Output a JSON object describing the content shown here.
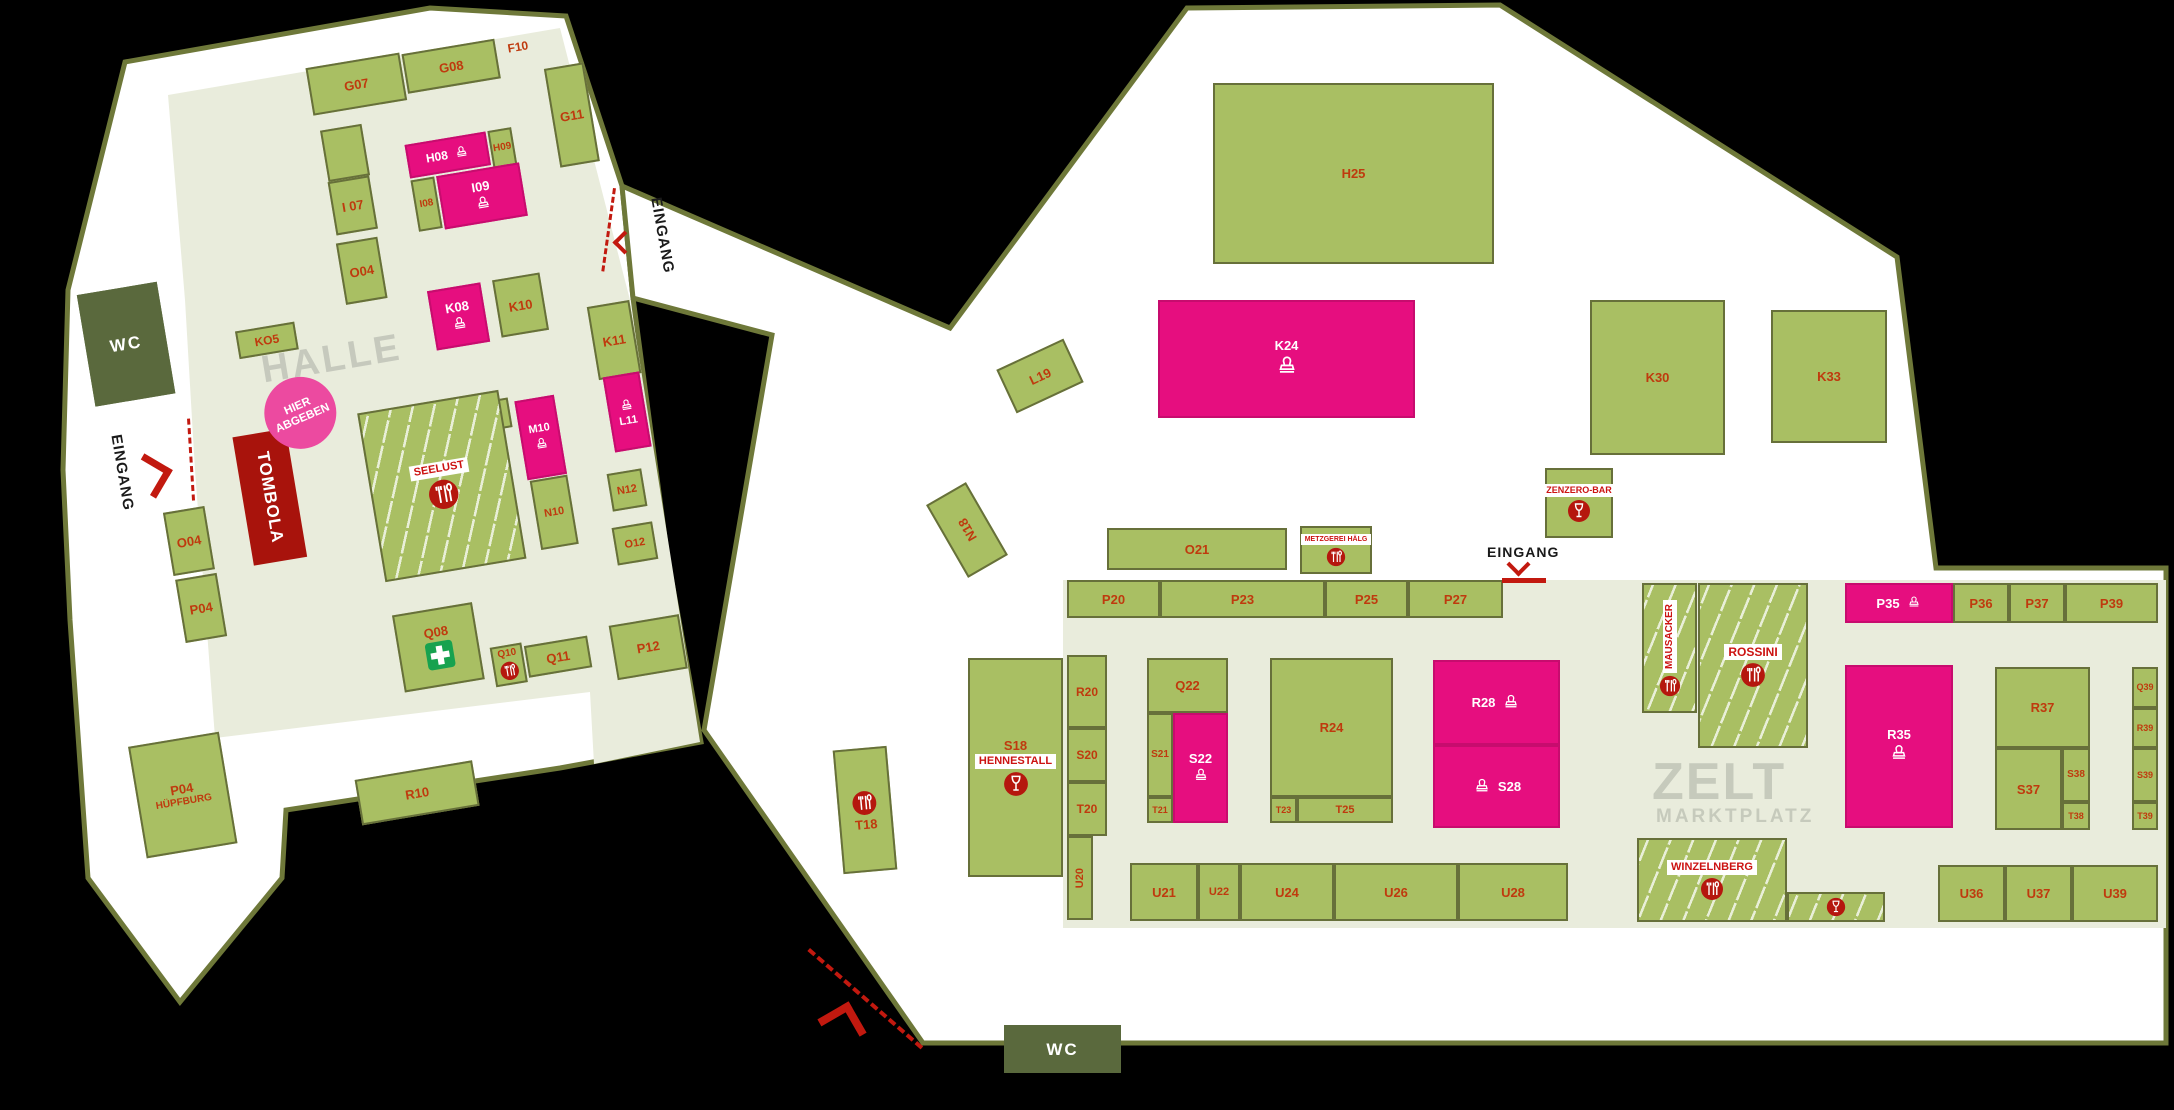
{
  "colors": {
    "green": "#a9bf63",
    "pink": "#e60e7f",
    "label_red": "#bf3a0e",
    "badge_red": "#cc1312",
    "dark_green": "#5a693d",
    "dark_red_tombola": "#a8130c",
    "accent_red": "#c2190f",
    "olive_border": "#6e7839",
    "map_light": "#e9ecdc",
    "title_gray": "#c6c9bd",
    "white": "#ffffff"
  },
  "halle": {
    "labels": {
      "title": "HALLE",
      "tombola": "TOMBOLA",
      "dropoff": "HIER ABGEBEN",
      "entrance_west": "EINGANG",
      "entrance_east": "EINGANG"
    },
    "stalls": [
      {
        "l": "G07",
        "x": 177,
        "y": 36,
        "w": 95,
        "h": 48
      },
      {
        "l": "G08",
        "x": 274,
        "y": 38,
        "w": 94,
        "h": 40
      },
      {
        "l": "F10",
        "x": 364,
        "y": 42,
        "w": 52,
        "h": 16,
        "k": "lbl"
      },
      {
        "l": "G11",
        "x": 412,
        "y": 76,
        "w": 40,
        "h": 100
      },
      {
        "l": "",
        "x": 181,
        "y": 100,
        "w": 42,
        "h": 52
      },
      {
        "l": "I 07",
        "x": 180,
        "y": 152,
        "w": 42,
        "h": 54
      },
      {
        "l": "O04",
        "x": 178,
        "y": 214,
        "w": 42,
        "h": 62
      },
      {
        "l": "H08",
        "x": 262,
        "y": 128,
        "w": 82,
        "h": 34,
        "k": "p",
        "i": "stamp-icon",
        "lay": "row",
        "is": 16,
        "fs": 12
      },
      {
        "l": "H09",
        "x": 346,
        "y": 128,
        "w": 24,
        "h": 38,
        "fs": 10
      },
      {
        "l": "I08",
        "x": 262,
        "y": 164,
        "w": 24,
        "h": 52,
        "fs": 10
      },
      {
        "l": "I09",
        "x": 288,
        "y": 164,
        "w": 84,
        "h": 54,
        "k": "p",
        "i": "stamp-icon",
        "is": 18
      },
      {
        "l": "K08",
        "x": 260,
        "y": 276,
        "w": 54,
        "h": 60,
        "k": "p",
        "i": "stamp-icon",
        "is": 18
      },
      {
        "l": "K10",
        "x": 326,
        "y": 276,
        "w": 48,
        "h": 58
      },
      {
        "l": "K11",
        "x": 415,
        "y": 318,
        "w": 43,
        "h": 74
      },
      {
        "l": "L11",
        "x": 419,
        "y": 390,
        "w": 37,
        "h": 76,
        "k": "p",
        "i": "stamp-icon",
        "lay": "stackrev",
        "is": 16,
        "fs": 11
      },
      {
        "l": "N12",
        "x": 407,
        "y": 486,
        "w": 35,
        "h": 38,
        "fs": 11
      },
      {
        "l": "O12",
        "x": 403,
        "y": 540,
        "w": 41,
        "h": 38,
        "fs": 11
      },
      {
        "l": "P12",
        "x": 384,
        "y": 636,
        "w": 71,
        "h": 55
      },
      {
        "l": "M09",
        "x": 218,
        "y": 394,
        "w": 104,
        "h": 30
      },
      {
        "l": "M10",
        "x": 328,
        "y": 399,
        "w": 40,
        "h": 80,
        "k": "p",
        "i": "stamp-icon",
        "is": 16,
        "fs": 11
      },
      {
        "l": "N10",
        "x": 330,
        "y": 480,
        "w": 38,
        "h": 70,
        "fs": 11
      },
      {
        "l": "",
        "badge": "SEELUST",
        "x": 171,
        "y": 385,
        "w": 143,
        "h": 171,
        "k": "pat",
        "i": "restaurant-icon",
        "is": 32
      },
      {
        "l": "Q08",
        "x": 172,
        "y": 590,
        "w": 81,
        "h": 78,
        "i": "firstaid-icon",
        "is": 30
      },
      {
        "l": "Q10",
        "x": 263,
        "y": 638,
        "w": 32,
        "h": 40,
        "i": "restaurant-icon",
        "is": 20,
        "fs": 10
      },
      {
        "l": "Q11",
        "x": 297,
        "y": 642,
        "w": 64,
        "h": 32
      },
      {
        "l": "KO5",
        "x": 64,
        "y": 284,
        "w": 60,
        "h": 28,
        "fs": 12
      },
      {
        "l": "O04",
        "x": -37,
        "y": 451,
        "w": 42,
        "h": 64
      },
      {
        "l": "P04",
        "x": -36,
        "y": 519,
        "w": 42,
        "h": 64
      },
      {
        "l": "R10",
        "x": 108,
        "y": 746,
        "w": 119,
        "h": 46
      },
      {
        "l": "P04",
        "sub": "HÜPFBURG",
        "x": -110,
        "y": 676,
        "w": 92,
        "h": 113
      },
      {
        "l": "WC",
        "x": -86,
        "y": 222,
        "w": 81,
        "h": 113,
        "k": "d"
      }
    ]
  },
  "zelt": {
    "labels": {
      "title": "ZELT",
      "subtitle": "MARKTPLATZ",
      "entrance": "EINGANG",
      "wc": "WC"
    },
    "stalls": [
      {
        "l": "H25",
        "x": 1213,
        "y": 83,
        "w": 281,
        "h": 181
      },
      {
        "l": "K24",
        "x": 1158,
        "y": 300,
        "w": 257,
        "h": 118,
        "k": "p",
        "i": "stamp-icon",
        "is": 26
      },
      {
        "l": "K30",
        "x": 1590,
        "y": 300,
        "w": 135,
        "h": 155
      },
      {
        "l": "K33",
        "x": 1771,
        "y": 310,
        "w": 116,
        "h": 133
      },
      {
        "l": "L19",
        "x": 1003,
        "y": 352,
        "w": 74,
        "h": 48,
        "rot": -25
      },
      {
        "l": "N18",
        "x": 944,
        "y": 488,
        "w": 46,
        "h": 84,
        "rot": -30,
        "vert": 1
      },
      {
        "l": "O21",
        "x": 1107,
        "y": 528,
        "w": 180,
        "h": 42
      },
      {
        "l": "",
        "badge": "METZGEREI HÄLG",
        "x": 1300,
        "y": 526,
        "w": 72,
        "h": 48,
        "i": "restaurant-icon",
        "is": 20,
        "bfs": 7
      },
      {
        "l": "",
        "badge": "ZENZERO-BAR",
        "x": 1545,
        "y": 468,
        "w": 68,
        "h": 70,
        "i": "wine-icon",
        "is": 24,
        "bfs": 9
      },
      {
        "l": "P20",
        "x": 1067,
        "y": 580,
        "w": 93,
        "h": 38
      },
      {
        "l": "P23",
        "x": 1160,
        "y": 580,
        "w": 165,
        "h": 38
      },
      {
        "l": "P25",
        "x": 1325,
        "y": 580,
        "w": 83,
        "h": 38
      },
      {
        "l": "P27",
        "x": 1408,
        "y": 580,
        "w": 95,
        "h": 38
      },
      {
        "l": "R20",
        "x": 1067,
        "y": 655,
        "w": 40,
        "h": 73,
        "fs": 12
      },
      {
        "l": "S20",
        "x": 1067,
        "y": 728,
        "w": 40,
        "h": 54,
        "fs": 12
      },
      {
        "l": "T20",
        "x": 1067,
        "y": 782,
        "w": 40,
        "h": 54,
        "fs": 12
      },
      {
        "l": "U20",
        "x": 1067,
        "y": 836,
        "w": 26,
        "h": 84,
        "vert": 1,
        "fs": 11
      },
      {
        "l": "Q22",
        "x": 1147,
        "y": 658,
        "w": 81,
        "h": 55
      },
      {
        "l": "S21",
        "x": 1147,
        "y": 713,
        "w": 26,
        "h": 84,
        "fs": 10
      },
      {
        "l": "S22",
        "x": 1173,
        "y": 713,
        "w": 55,
        "h": 110,
        "k": "p",
        "i": "stamp-icon",
        "is": 18
      },
      {
        "l": "T21",
        "x": 1147,
        "y": 797,
        "w": 26,
        "h": 26,
        "fs": 9
      },
      {
        "l": "R24",
        "x": 1270,
        "y": 658,
        "w": 123,
        "h": 139
      },
      {
        "l": "T23",
        "x": 1270,
        "y": 797,
        "w": 27,
        "h": 26,
        "fs": 9
      },
      {
        "l": "T25",
        "x": 1297,
        "y": 797,
        "w": 96,
        "h": 26,
        "fs": 11
      },
      {
        "l": "R28",
        "x": 1433,
        "y": 660,
        "w": 127,
        "h": 85,
        "k": "p",
        "i": "stamp-icon",
        "lay": "row",
        "is": 20
      },
      {
        "l": "S28",
        "x": 1433,
        "y": 745,
        "w": 127,
        "h": 83,
        "k": "p",
        "i": "stamp-icon",
        "lay": "rowrev",
        "is": 20
      },
      {
        "l": "",
        "badge": "MAUSACKER",
        "x": 1642,
        "y": 583,
        "w": 55,
        "h": 130,
        "k": "pat",
        "i": "restaurant-icon",
        "is": 22,
        "vbadge": 1,
        "bfs": 10
      },
      {
        "l": "",
        "badge": "ROSSINI",
        "x": 1698,
        "y": 583,
        "w": 110,
        "h": 165,
        "k": "pat",
        "i": "restaurant-icon",
        "is": 26,
        "bfs": 12
      },
      {
        "l": "P35",
        "x": 1845,
        "y": 583,
        "w": 108,
        "h": 40,
        "k": "p",
        "i": "stamp-icon",
        "lay": "row",
        "is": 16
      },
      {
        "l": "P36",
        "x": 1953,
        "y": 583,
        "w": 56,
        "h": 40
      },
      {
        "l": "P37",
        "x": 2009,
        "y": 583,
        "w": 56,
        "h": 40
      },
      {
        "l": "P39",
        "x": 2065,
        "y": 583,
        "w": 93,
        "h": 40
      },
      {
        "l": "R35",
        "x": 1845,
        "y": 665,
        "w": 108,
        "h": 163,
        "k": "p",
        "i": "stamp-icon",
        "is": 22
      },
      {
        "l": "R37",
        "x": 1995,
        "y": 667,
        "w": 95,
        "h": 81
      },
      {
        "l": "S37",
        "x": 1995,
        "y": 748,
        "w": 67,
        "h": 82
      },
      {
        "l": "S38",
        "x": 2062,
        "y": 748,
        "w": 28,
        "h": 54,
        "fs": 10
      },
      {
        "l": "T38",
        "x": 2062,
        "y": 802,
        "w": 28,
        "h": 28,
        "fs": 9
      },
      {
        "l": "Q39",
        "x": 2132,
        "y": 667,
        "w": 26,
        "h": 41,
        "fs": 9
      },
      {
        "l": "R39",
        "x": 2132,
        "y": 708,
        "w": 26,
        "h": 40,
        "fs": 9
      },
      {
        "l": "S39",
        "x": 2132,
        "y": 748,
        "w": 26,
        "h": 54,
        "fs": 9
      },
      {
        "l": "T39",
        "x": 2132,
        "y": 802,
        "w": 26,
        "h": 28,
        "fs": 9
      },
      {
        "l": "S18",
        "badge": "HENNESTALL",
        "x": 968,
        "y": 658,
        "w": 95,
        "h": 219,
        "i": "wine-icon",
        "is": 26
      },
      {
        "l": "T18",
        "x": 838,
        "y": 748,
        "w": 54,
        "h": 124,
        "rot": -5,
        "i": "restaurant-icon",
        "lay": "stackrev",
        "is": 26
      },
      {
        "l": "U21",
        "x": 1130,
        "y": 863,
        "w": 68,
        "h": 58
      },
      {
        "l": "U22",
        "x": 1198,
        "y": 863,
        "w": 42,
        "h": 58,
        "fs": 11
      },
      {
        "l": "U24",
        "x": 1240,
        "y": 863,
        "w": 94,
        "h": 58
      },
      {
        "l": "U26",
        "x": 1334,
        "y": 863,
        "w": 124,
        "h": 58
      },
      {
        "l": "U28",
        "x": 1458,
        "y": 863,
        "w": 110,
        "h": 58
      },
      {
        "l": "",
        "badge": "WINZELNBERG",
        "x": 1637,
        "y": 838,
        "w": 150,
        "h": 84,
        "k": "pat",
        "i": "restaurant-icon",
        "is": 24,
        "bfs": 11
      },
      {
        "l": "",
        "x": 1787,
        "y": 892,
        "w": 98,
        "h": 30,
        "k": "pat",
        "i": "wine-icon",
        "is": 20,
        "lay": "row"
      },
      {
        "l": "U36",
        "x": 1938,
        "y": 865,
        "w": 67,
        "h": 57
      },
      {
        "l": "U37",
        "x": 2005,
        "y": 865,
        "w": 67,
        "h": 57
      },
      {
        "l": "U39",
        "x": 2072,
        "y": 865,
        "w": 86,
        "h": 57
      },
      {
        "l": "WC",
        "x": 1004,
        "y": 1025,
        "w": 117,
        "h": 48,
        "k": "d"
      }
    ]
  }
}
